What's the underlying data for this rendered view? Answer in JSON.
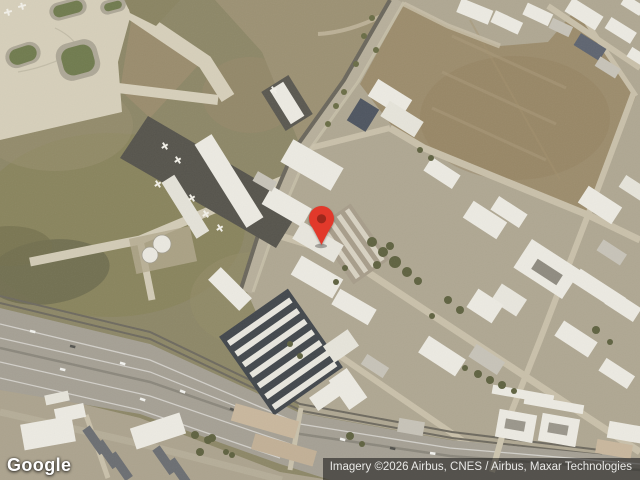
{
  "map": {
    "view_type": "satellite",
    "pin": {
      "color": "#E2392B",
      "inner_color": "#9E281C"
    }
  },
  "footer": {
    "logo_text": "Google",
    "attribution": "Imagery ©2026 Airbus, CNES / Airbus, Maxar Technologies"
  }
}
